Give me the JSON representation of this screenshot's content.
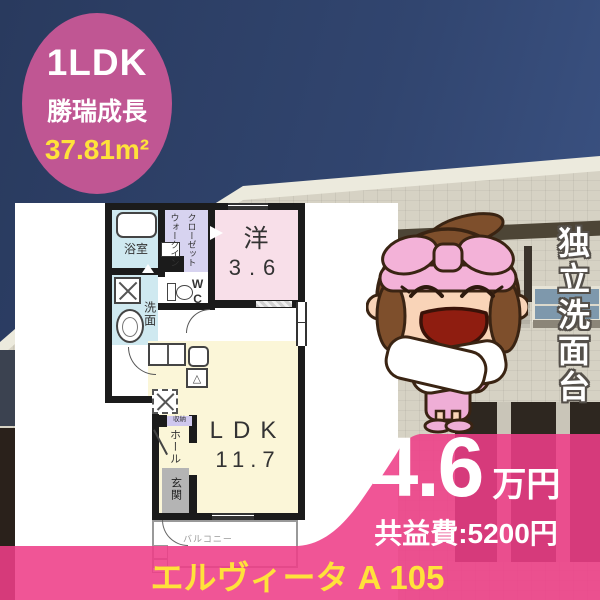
{
  "badge": {
    "type": "1LDK",
    "location": "勝瑞成長",
    "area": "37.81m²"
  },
  "feature_vertical": "独立洗面台",
  "price": {
    "value": "4.6",
    "unit": "万円",
    "fee": "共益費:5200円"
  },
  "property_name": "エルヴィータ A 105",
  "floorplan": {
    "bath": "浴室",
    "wic_col1": "ウォークイン",
    "wic_col2": "クローゼット",
    "western_room": "洋",
    "western_size": "3.6",
    "laundry": "洗面",
    "wc": "WC",
    "storage": "収納",
    "hall": "ホール",
    "entrance": "玄関",
    "ldk": "LDK",
    "ldk_size": "11.7",
    "balcony": "バルコニー"
  },
  "colors": {
    "badge_pink": "#c05693",
    "band_pink": "#ee3d88",
    "highlight_yellow": "#ffe23a",
    "room_bath": "#cfe9f0",
    "room_wic": "#d7d3f0",
    "room_western": "#f8dfe9",
    "room_ldk": "#fbf6d8",
    "room_entrance": "#b4b4b4"
  }
}
